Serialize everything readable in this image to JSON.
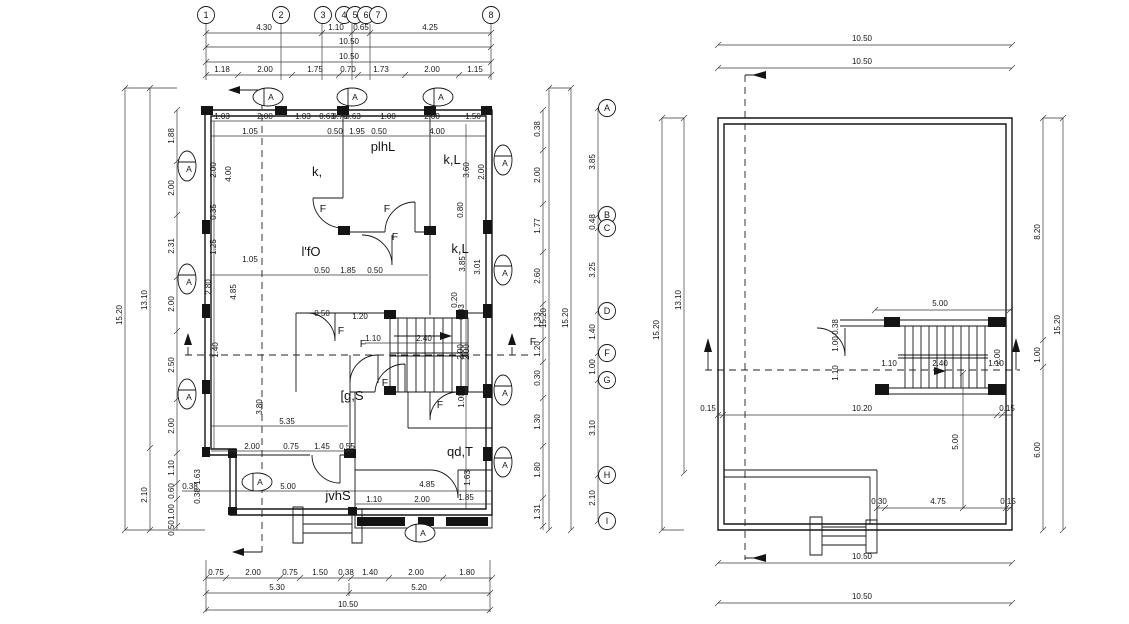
{
  "left_plan": {
    "grid_cols": [
      "1",
      "2",
      "3",
      "4",
      "5",
      "6",
      "7",
      "8"
    ],
    "grid_rows": [
      "A",
      "B",
      "C",
      "D",
      "F",
      "G",
      "H",
      "I"
    ],
    "dims": {
      "top1": [
        "4.30",
        "1.10",
        "0.65",
        "4.25"
      ],
      "top2": [
        "10.50"
      ],
      "top3": [
        "10.50"
      ],
      "top4": [
        "1.18",
        "2.00",
        "1.75",
        "0.70",
        "1.73",
        "2.00",
        "1.15"
      ],
      "bottom1": [
        "0.75",
        "2.00",
        "0.75",
        "1.50",
        "0.38",
        "1.40",
        "2.00",
        "1.80"
      ],
      "bottom2": [
        "5.30",
        "5.20"
      ],
      "bottom3": [
        "10.50"
      ],
      "left_outer": [
        "15.20"
      ],
      "left_mid": [
        "13.10",
        "2.10"
      ],
      "left_chain": [
        "1.88",
        "2.00",
        "2.31",
        "2.00",
        "2.50",
        "2.00",
        "1.10",
        "0.60",
        "1.00",
        "0.50"
      ],
      "right_outer": [
        "15.20",
        "15.20"
      ],
      "right_rows": [
        "3.85",
        "0.48",
        "3.25",
        "1.40",
        "1.00",
        "3.10",
        "2.10"
      ],
      "right_chain": [
        "0.38",
        "2.00",
        "1.77",
        "2.60",
        "1.33",
        "1.20",
        "0.30",
        "1.30",
        "1.80",
        "1.31"
      ],
      "int_a": [
        "1.03",
        "2.00",
        "1.03",
        "0.63",
        "0.70",
        "0.63",
        "1.00",
        "2.00",
        "1.50"
      ],
      "int_b": [
        "1.05",
        "0.50",
        "1.95",
        "0.50",
        "4.00"
      ],
      "int_c": [
        "1.05",
        "0.50",
        "1.85",
        "0.50"
      ],
      "int_d": [
        "0.50",
        "1.20"
      ],
      "stair_c": [
        "1.10",
        "2.40"
      ],
      "stair_rot": [
        "2.00"
      ],
      "int_e": [
        "5.35",
        "2.00",
        "0.75",
        "1.45",
        "0.55"
      ],
      "int_f": [
        "0.38",
        "5.00",
        "4.85"
      ],
      "int_g": [
        "1.10",
        "2.00",
        "1.85"
      ],
      "left_rot": [
        "2.00",
        "4.00",
        "0.35",
        "1.25",
        "2.80",
        "4.85",
        "1.40",
        "3.80",
        "1.63",
        "0.38"
      ],
      "right_rot": [
        "3.60",
        "2.00",
        "0.80",
        "3.85",
        "3.01",
        "0.20",
        "0.83",
        "2.00",
        "1.00",
        "1.63"
      ]
    },
    "rooms": [
      "k,",
      "plhL",
      "k,L",
      "l'fO",
      "k,L",
      "[g,S",
      "qd,T",
      "jvhS"
    ],
    "door_tags": [
      "F",
      "F",
      "F",
      "F",
      "F",
      "F",
      "F",
      "F"
    ],
    "window_tags": [
      "A",
      "A",
      "A",
      "A",
      "A",
      "A",
      "A",
      "A",
      "A",
      "A",
      "A",
      "A"
    ]
  },
  "right_plan": {
    "dims": {
      "top1": [
        "10.50"
      ],
      "top2": [
        "10.50"
      ],
      "bottom1": [
        "10.50"
      ],
      "bottom2": [
        "10.50"
      ],
      "left": [
        "15.20",
        "13.10"
      ],
      "right_chain": [
        "8.20",
        "1.00",
        "6.00"
      ],
      "right_outer": [
        "15.20"
      ],
      "stair_top": [
        "5.00"
      ],
      "stair_center": [
        "1.10",
        "2.40",
        "1.10"
      ],
      "stair_rot": [
        "2.00"
      ],
      "stair_left": [
        "0.38",
        "1.00",
        "1.10"
      ],
      "mid": [
        "0.15",
        "10.20",
        "0.15"
      ],
      "mid_vert": [
        "5.00"
      ],
      "low": [
        "0.30",
        "4.75",
        "0.15"
      ]
    }
  }
}
